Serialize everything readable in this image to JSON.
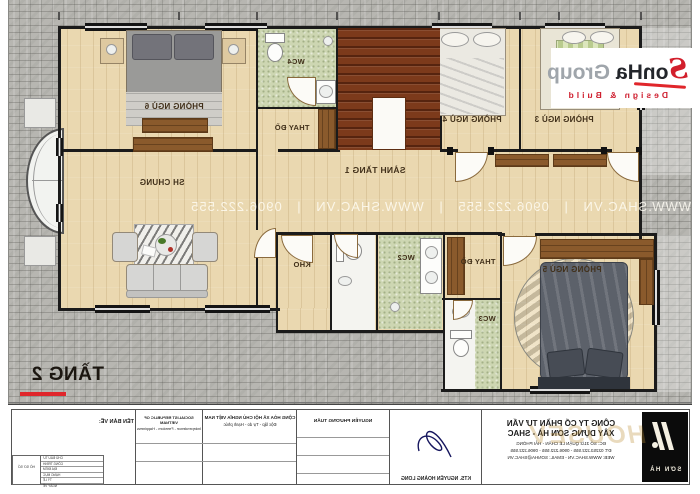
{
  "sheet": {
    "title": "TẦNG 2"
  },
  "brand": {
    "s": "S",
    "name": "onHa",
    "group": "Group",
    "tagline": "Design & Build"
  },
  "watermark": {
    "row": "WWW.SHAC.VN   |   0906.222.555   |   WWW.SHAC.VN   |   0906.222.555"
  },
  "plan": {
    "labels": {
      "bed6": "PHÒNG NGỦ 6",
      "bed5": "PHÒNG NGỦ 5",
      "bed4": "PHÒNG NGỦ 4",
      "bed3": "PHÒNG NGỦ 3",
      "hall": "SẢNH TẦNG 1",
      "living": "SH CHUNG",
      "storage": "KHO",
      "wc2": "WC2",
      "wc3": "WC3",
      "wc4": "WC4",
      "dressing1": "THAY ĐỒ",
      "dressing2": "THAY ĐỒ"
    }
  },
  "titleblock": {
    "drawing_label": "TÊN BẢN VẼ:",
    "company_line1": "CÔNG TY CỔ PHẦN TƯ VẤN",
    "company_line2": "XÂY DỰNG SƠN HÀ - SHAC",
    "company_address": "ĐC: SỐ 31/2 QUẬN LÊ CHÂN - HẢI PHÒNG",
    "company_phone": "ĐT: 02253.222.555 - 0906.222.555 - 0906.222.555",
    "company_web": "WEB: WWW.SHAC.VN - EMAIL: SONHA@SHAC.VN",
    "logo_text": "SƠN HÀ",
    "gold_watermark": "HOUSEV",
    "architect": "KTS. NGUYỄN HOÀNG LONG",
    "chief_architect": "NGUYỄN PHƯƠNG TUẤN",
    "motto_vn1": "CỘNG HÒA XÃ HỘI CHỦ NGHĨA VIỆT NAM",
    "motto_vn2": "Độc lập - Tự do - Hạnh phúc",
    "motto_en1": "SOCIALIST REPUBLIC OF VIETNAM",
    "motto_en2": "Independence - Freedom - Happiness",
    "hs_label": "HỒ SƠ SỐ",
    "rows": [
      "CHỦ ĐẦU TƯ",
      "CÔNG TRÌNH",
      "ĐỊA ĐIỂM",
      "HẠNG MỤC",
      "TỶ LỆ",
      "NGÀY VẼ"
    ]
  }
}
